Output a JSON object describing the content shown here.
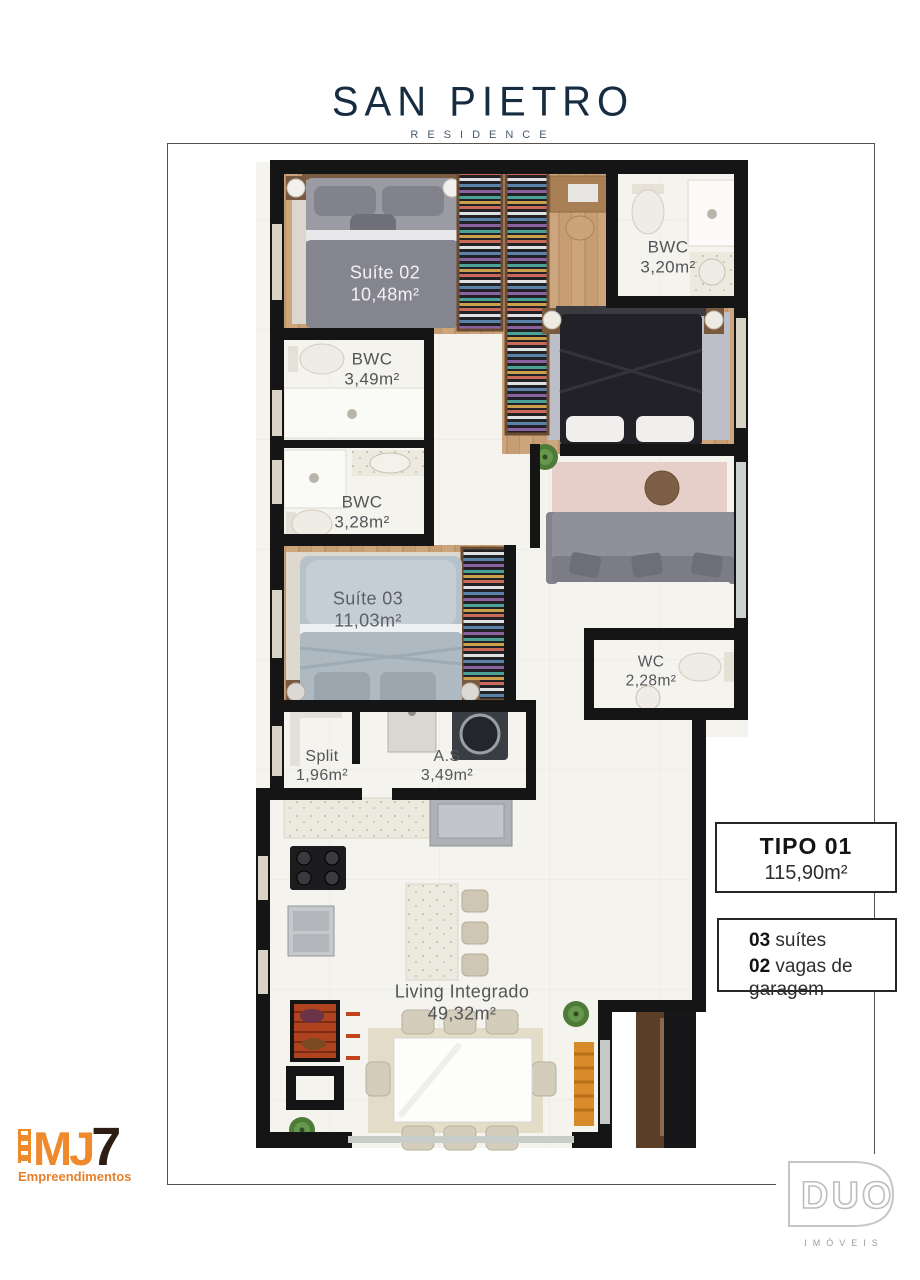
{
  "header": {
    "title": "SAN PIETRO",
    "subtitle": "RESIDENCE"
  },
  "plan": {
    "rooms": {
      "suite02": {
        "name": "Suíte 02",
        "area": "10,48m²"
      },
      "bwc_top": {
        "name": "BWC",
        "area": "3,20m²"
      },
      "bwc_mid": {
        "name": "BWC",
        "area": "3,49m²"
      },
      "bwc_low": {
        "name": "BWC",
        "area": "3,28m²"
      },
      "suite03": {
        "name": "Suíte 03",
        "area": "11,03m²"
      },
      "wc": {
        "name": "WC",
        "area": "2,28m²"
      },
      "split": {
        "name": "Split",
        "area": "1,96m²"
      },
      "as": {
        "name": "A.S",
        "area": "3,49m²"
      },
      "living": {
        "name": "Living Integrado",
        "area": "49,32m²"
      }
    }
  },
  "info": {
    "tipo": {
      "title": "TIPO 01",
      "area": "115,90m²"
    },
    "specs": [
      {
        "qty": "03",
        "label": " suítes"
      },
      {
        "qty": "02",
        "label": " vagas de garagem"
      }
    ]
  },
  "logos": {
    "mj7": {
      "mj": "MJ",
      "seven": "7",
      "sub": "Empreendimentos"
    },
    "duo": {
      "name": "DUO",
      "sub": "IMÓVEIS"
    }
  },
  "colors": {
    "title_navy": "#172c40",
    "wall_black": "#151515",
    "wood_floor": "#c79e74",
    "mj7_orange": "#ee8a2c",
    "grill_brick": "#b0431f"
  }
}
